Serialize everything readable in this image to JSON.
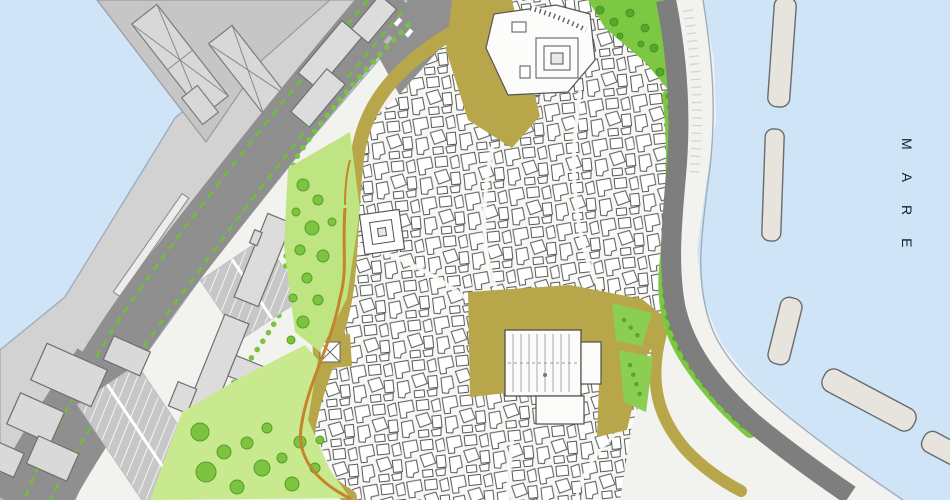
{
  "map": {
    "kind": "urban-plan-of-coastal-old-town",
    "sea_label": "MARE",
    "colors": {
      "sea": "#cfe4f7",
      "quay_gray": "#d2d2d2",
      "pier_gray": "#c6c6c6",
      "east_land": "#f2f2ee",
      "road_gray": "#8f8f8f",
      "coastal_road_gray": "#7e7e7e",
      "promenade": "#f3f2ee",
      "old_town_ground": "#f7f7f4",
      "building_fill": "#ffffff",
      "building_outline": "#585858",
      "modern_building_fill": "#dcdcdc",
      "open_space_khaki": "#b8a74a",
      "park_light": "#c9e98f",
      "park_strip_bright": "#7cc843",
      "tree_green": "#7cc440",
      "tree_dark_green": "#55a82c",
      "road_median_dash_green": "#6fbf3a",
      "city_wall_orange": "#c5832b",
      "breakwater_fill": "#e7e4dd",
      "breakwater_outline": "#696b6e",
      "waterline": "#a0adbd",
      "sea_label_color": "#16212e"
    }
  }
}
